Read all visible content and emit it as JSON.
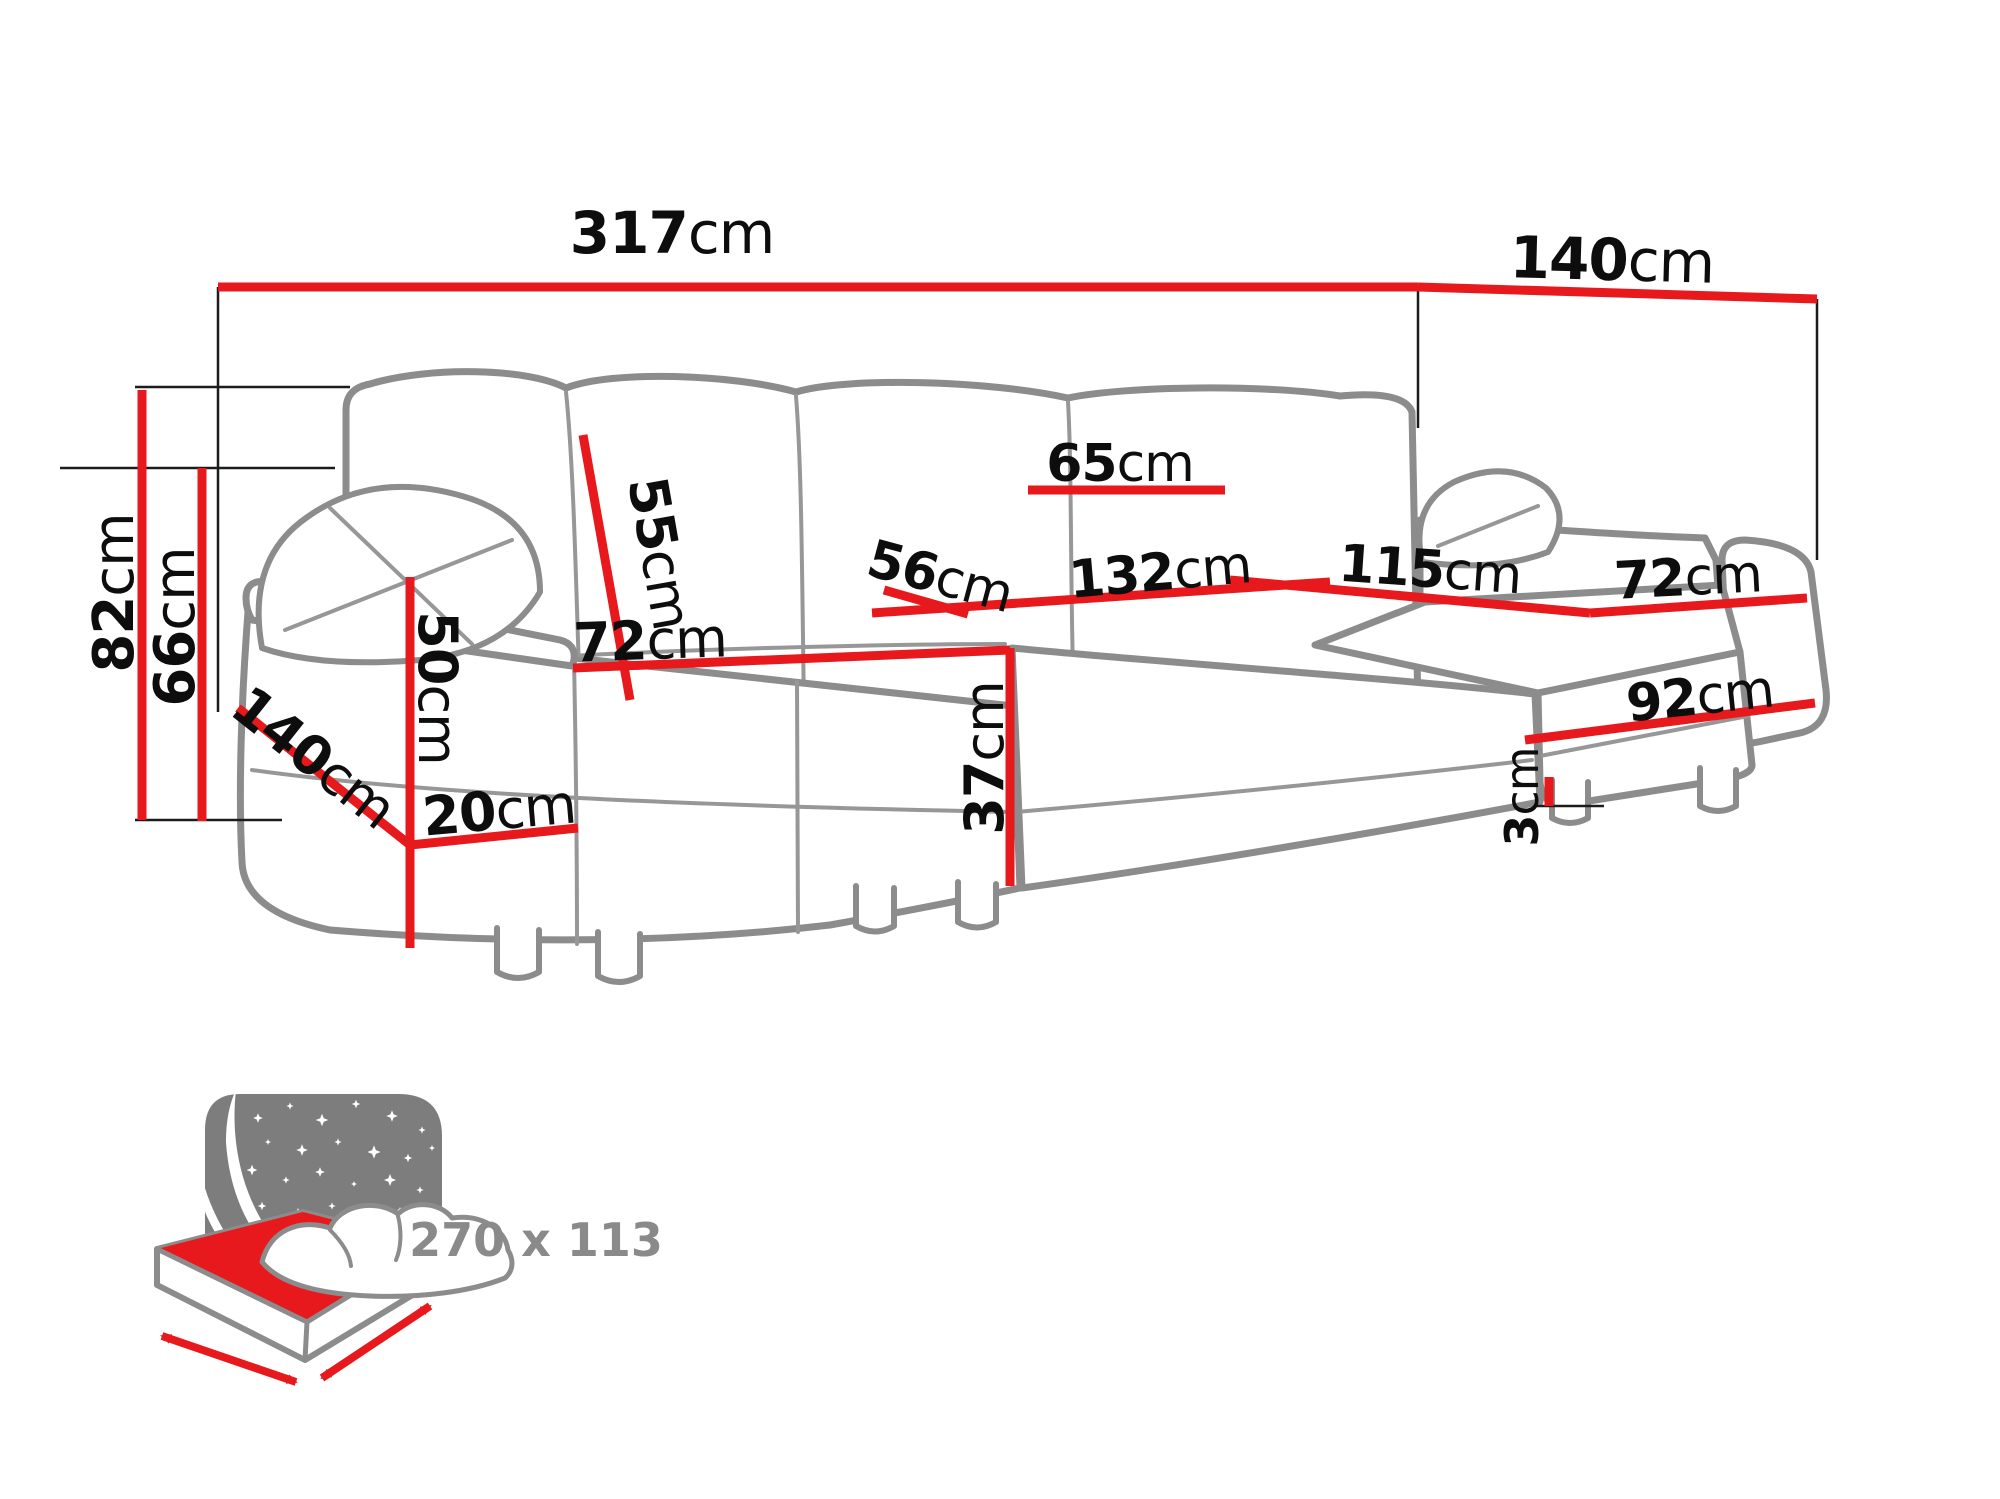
{
  "figure": {
    "kind": "furniture-dimension-diagram",
    "subject": "U-shaped corner sofa bed line drawing with red dimension lines"
  },
  "colors": {
    "dimension_line_red": "#e8191d",
    "sofa_outline_gray": "#8c8c8c",
    "extension_line_black": "#1c1c1c",
    "label_black": "#0d0d0d",
    "icon_gray": "#7d7d7d",
    "icon_text_gray": "#8a8a8a"
  },
  "dimensions": [
    {
      "id": "total-width",
      "value": "317",
      "unit": "cm"
    },
    {
      "id": "right-depth",
      "value": "140",
      "unit": "cm"
    },
    {
      "id": "total-height",
      "value": "82",
      "unit": "cm"
    },
    {
      "id": "armrest-height",
      "value": "66",
      "unit": "cm"
    },
    {
      "id": "back-cushion-height",
      "value": "55",
      "unit": "cm"
    },
    {
      "id": "back-cushion-width",
      "value": "65",
      "unit": "cm"
    },
    {
      "id": "corner-seat-depth",
      "value": "56",
      "unit": "cm"
    },
    {
      "id": "center-seat-width",
      "value": "132",
      "unit": "cm"
    },
    {
      "id": "right-seat-length",
      "value": "115",
      "unit": "cm"
    },
    {
      "id": "right-seat-width",
      "value": "72",
      "unit": "cm"
    },
    {
      "id": "right-front-width",
      "value": "92",
      "unit": "cm"
    },
    {
      "id": "leg-height",
      "value": "3",
      "unit": "cm"
    },
    {
      "id": "seat-height",
      "value": "37",
      "unit": "cm"
    },
    {
      "id": "left-seat-width",
      "value": "72",
      "unit": "cm"
    },
    {
      "id": "arm-panel-height",
      "value": "50",
      "unit": "cm"
    },
    {
      "id": "base-height",
      "value": "20",
      "unit": "cm"
    },
    {
      "id": "left-chaise-depth",
      "value": "140",
      "unit": "cm"
    }
  ],
  "sleeping_area": {
    "label": "270 x 113"
  }
}
